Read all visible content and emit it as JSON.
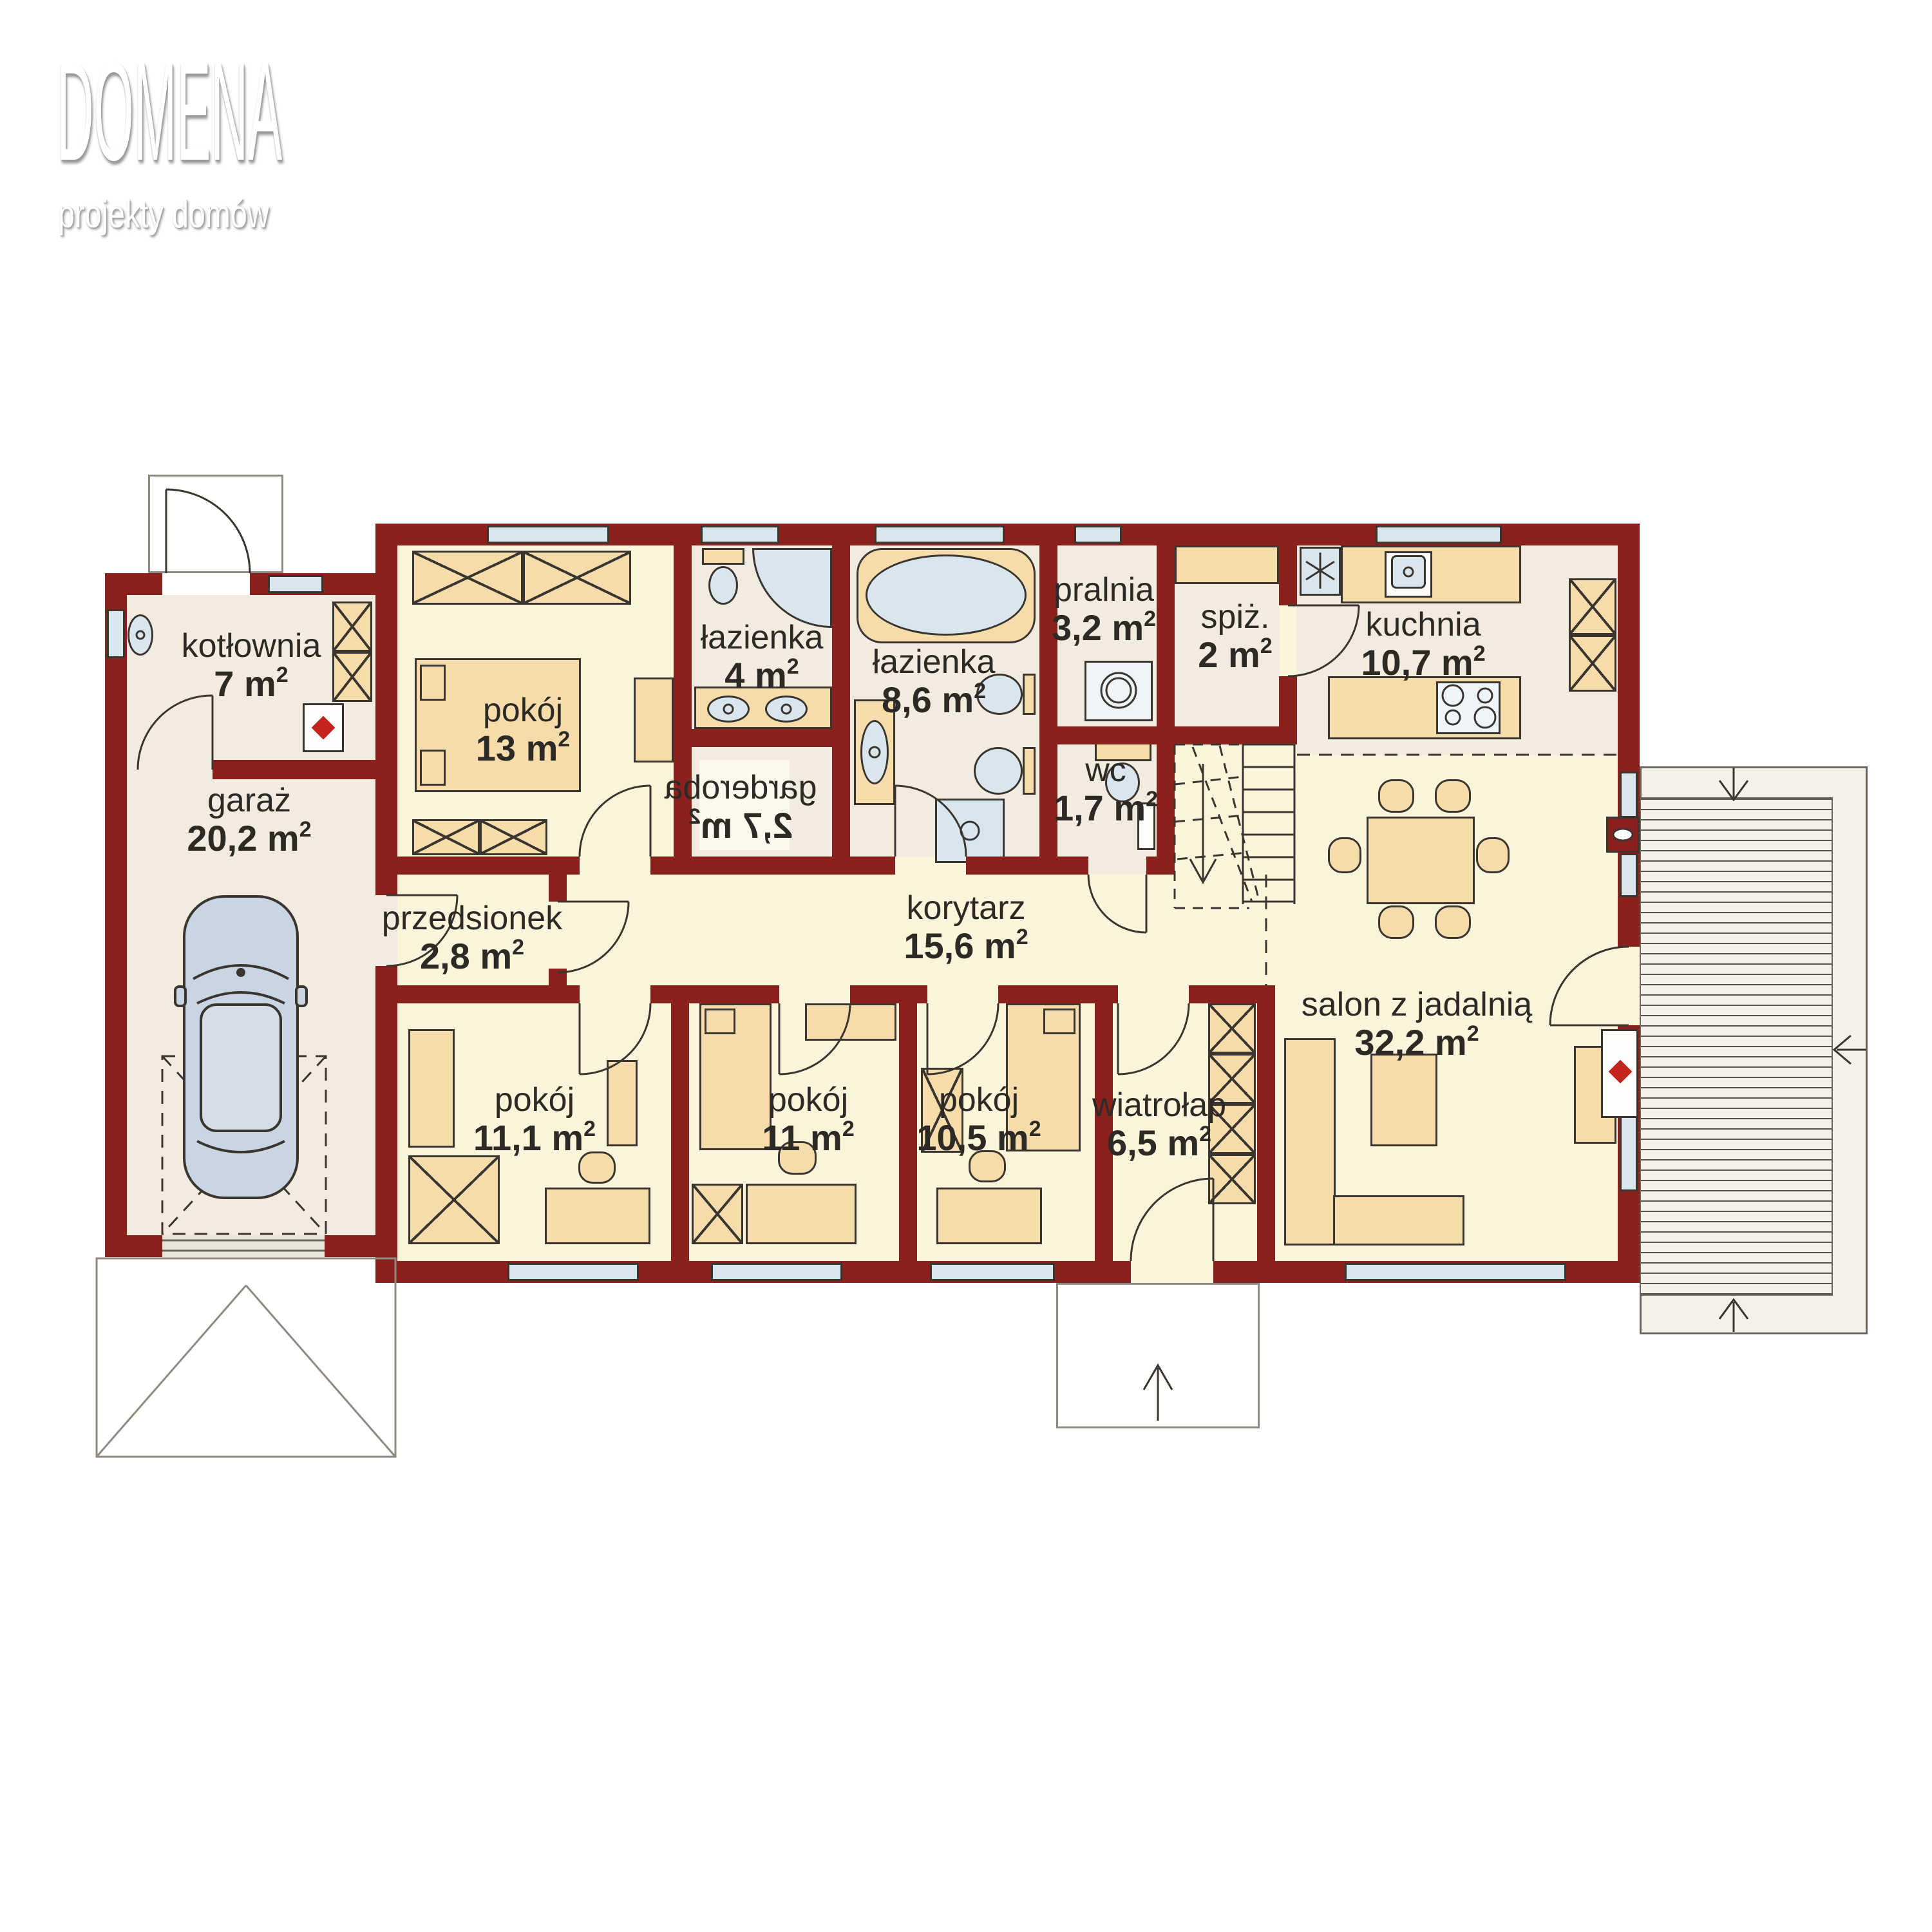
{
  "brand": {
    "name": "DOMENA",
    "tagline": "projekty domów"
  },
  "rooms": [
    {
      "key": "kotlownia",
      "name": "kotłownia",
      "area": "7 m",
      "sup": "2"
    },
    {
      "key": "garaz",
      "name": "garaż",
      "area": "20,2 m",
      "sup": "2"
    },
    {
      "key": "pokoj-13",
      "name": "pokój",
      "area": "13 m",
      "sup": "2"
    },
    {
      "key": "lazienka-4",
      "name": "łazienka",
      "area": "4 m",
      "sup": "2"
    },
    {
      "key": "garderoba",
      "name": "garderoba",
      "area": "2,7 m",
      "sup": "2",
      "mirrored": true
    },
    {
      "key": "lazienka-86",
      "name": "łazienka",
      "area": "8,6 m",
      "sup": "2"
    },
    {
      "key": "pralnia",
      "name": "pralnia",
      "area": "3,2 m",
      "sup": "2"
    },
    {
      "key": "spizarnia",
      "name": "spiż.",
      "area": "2 m",
      "sup": "2"
    },
    {
      "key": "kuchnia",
      "name": "kuchnia",
      "area": "10,7 m",
      "sup": "2"
    },
    {
      "key": "wc",
      "name": "wc",
      "area": "1,7 m",
      "sup": "2"
    },
    {
      "key": "przedsionek",
      "name": "przedsionek",
      "area": "2,8 m",
      "sup": "2"
    },
    {
      "key": "korytarz",
      "name": "korytarz",
      "area": "15,6 m",
      "sup": "2"
    },
    {
      "key": "pokoj-111",
      "name": "pokój",
      "area": "11,1 m",
      "sup": "2"
    },
    {
      "key": "pokoj-11",
      "name": "pokój",
      "area": "11 m",
      "sup": "2"
    },
    {
      "key": "pokoj-105",
      "name": "pokój",
      "area": "10,5 m",
      "sup": "2"
    },
    {
      "key": "wiatrolap",
      "name": "wiatrołap",
      "area": "6,5 m",
      "sup": "2"
    },
    {
      "key": "salon",
      "name": "salon z jadalnią",
      "area": "32,2 m",
      "sup": "2"
    }
  ],
  "colors": {
    "wall": "#8a211d",
    "floor": "#faf4da",
    "floor_service": "#f2ebe0",
    "furniture": "#f6dcab",
    "fixture": "#d9e6ee",
    "outline": "#3a352f",
    "accent_red": "#c2231d",
    "terrace_line": "#6b665e",
    "porch_line": "#8f8a80",
    "window": "#d9e6ee",
    "text": "#2d2a26"
  }
}
